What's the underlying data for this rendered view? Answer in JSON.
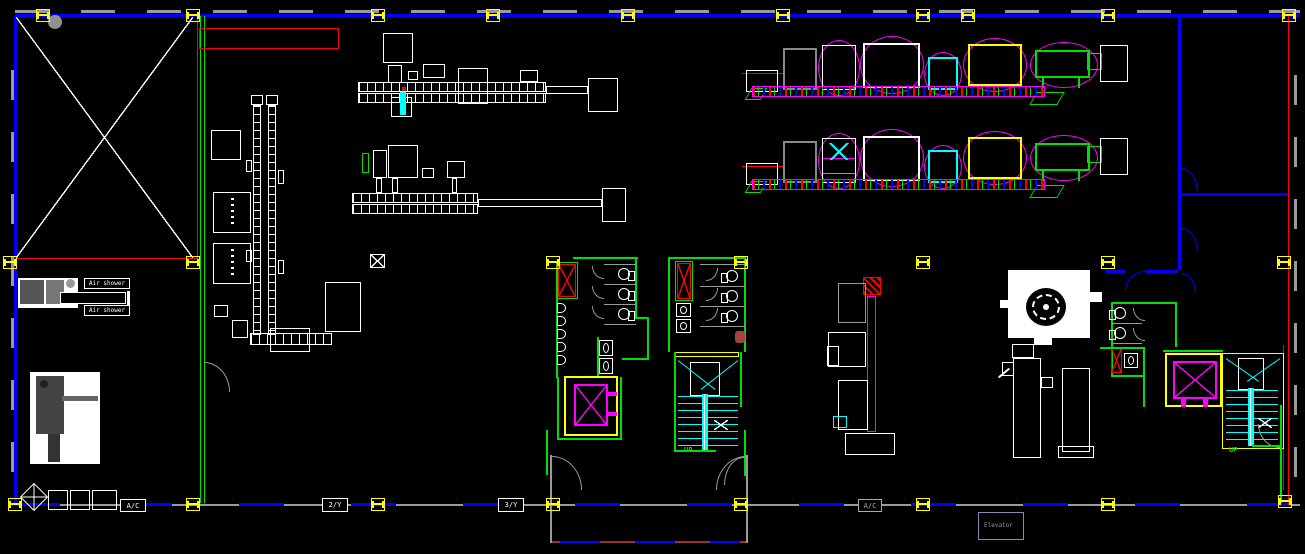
{
  "plan": {
    "type": "factory-floor-plan",
    "view": "cad-model-space"
  },
  "colors": {
    "bg": "#000000",
    "blue": "#0000ff",
    "green": "#00e000",
    "gray": "#9a9a9a",
    "red": "#ff0000",
    "yellow": "#ffff00",
    "magenta": "#ff00ff",
    "cyan": "#00ffff",
    "white": "#ffffff",
    "darkred": "#993333",
    "slate": "#8888bb",
    "circle": "#909090"
  },
  "labels": {
    "air_shower_1": "Air shower",
    "air_shower_2": "Air shower",
    "floor_tag_1": "2/Y",
    "floor_tag_2": "3/Y",
    "ac_1": "A/C",
    "ac_2": "A/C",
    "elevator": "Elevator",
    "up_1": "UP",
    "up_2": "UP"
  }
}
